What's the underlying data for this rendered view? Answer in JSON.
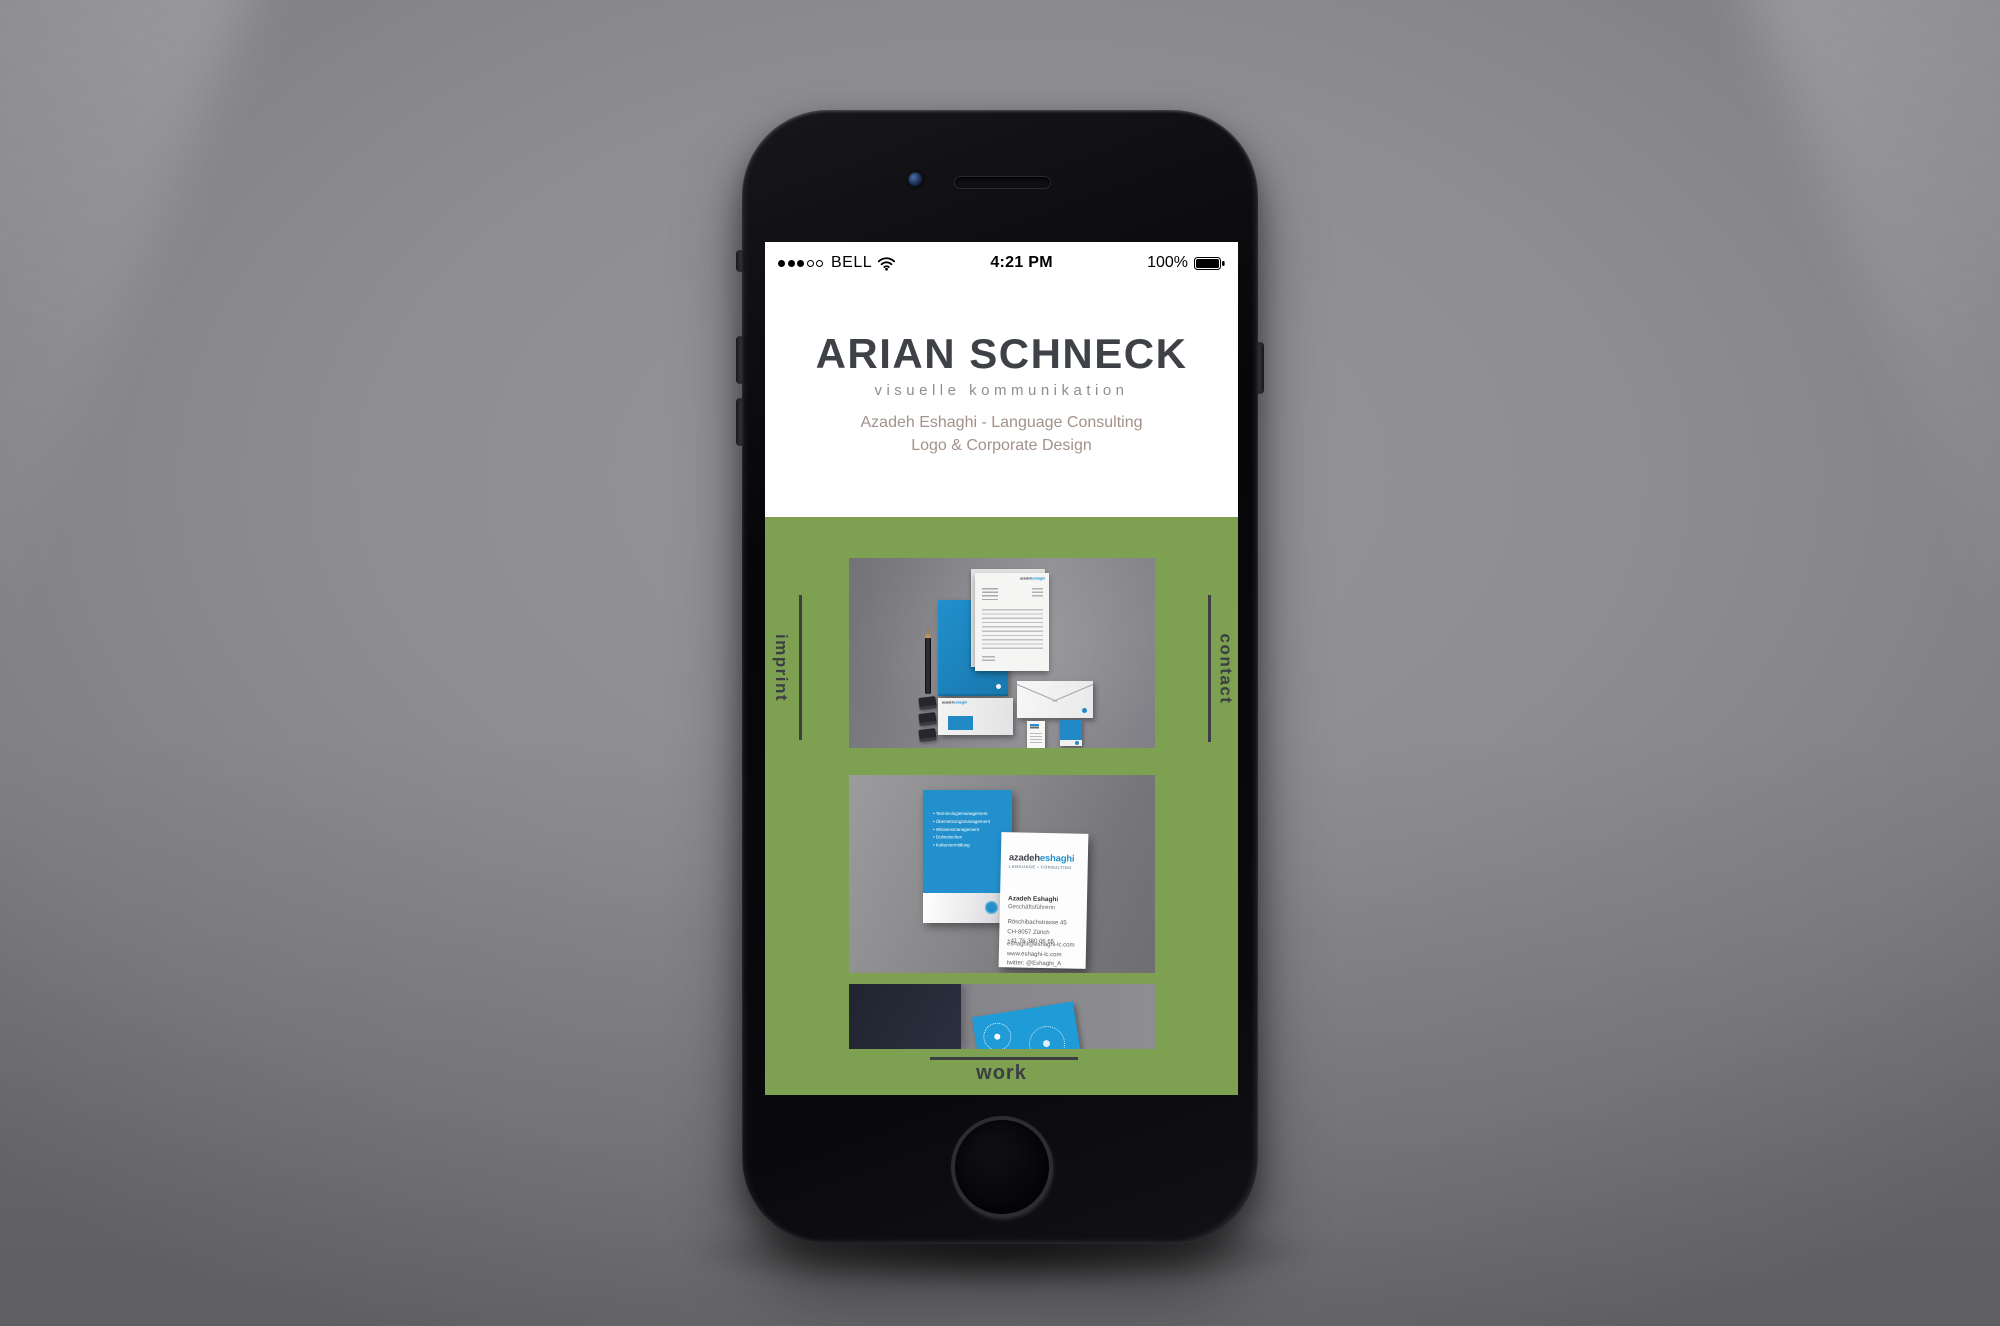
{
  "status_bar": {
    "carrier": "BELL",
    "time": "4:21 PM",
    "battery": "100%"
  },
  "header": {
    "title": "ARIAN SCHNECK",
    "subtitle": "visuelle kommunikation",
    "tagline_1": "Azadeh Eshaghi - Language Consulting",
    "tagline_2": "Logo & Corporate Design"
  },
  "nav": {
    "imprint": "imprint",
    "contact": "contact",
    "work": "work"
  },
  "colors": {
    "accent_blue": "#2290cd",
    "section_green": "#7da151",
    "text_dark": "#3b3e43",
    "tagline_brown": "#a2928a"
  },
  "stationery": {
    "logo_dark": "azadeh",
    "logo_blue": "eshaghi"
  },
  "business_card": {
    "back_bullets": [
      "Terminologiemanagement",
      "Übersetzungsmanagement",
      "Wissensmanagement",
      "Dolmetschen",
      "Kulturvermittlung"
    ],
    "front": {
      "brand_dark": "azadeh",
      "brand_blue": "eshaghi",
      "tagline": "LANGUAGE • CONSULTING",
      "name": "Azadeh Eshaghi",
      "role": "Geschäftsführerin",
      "address_line_1": "Röschibachstrasse 45",
      "address_line_2": "CH-8057 Zürich",
      "phone": "+41 76 380 06 65",
      "email": "eshaghi@eshaghi-lc.com",
      "website": "www.eshaghi-lc.com",
      "twitter": "twitter: @Eshaghi_A"
    }
  }
}
